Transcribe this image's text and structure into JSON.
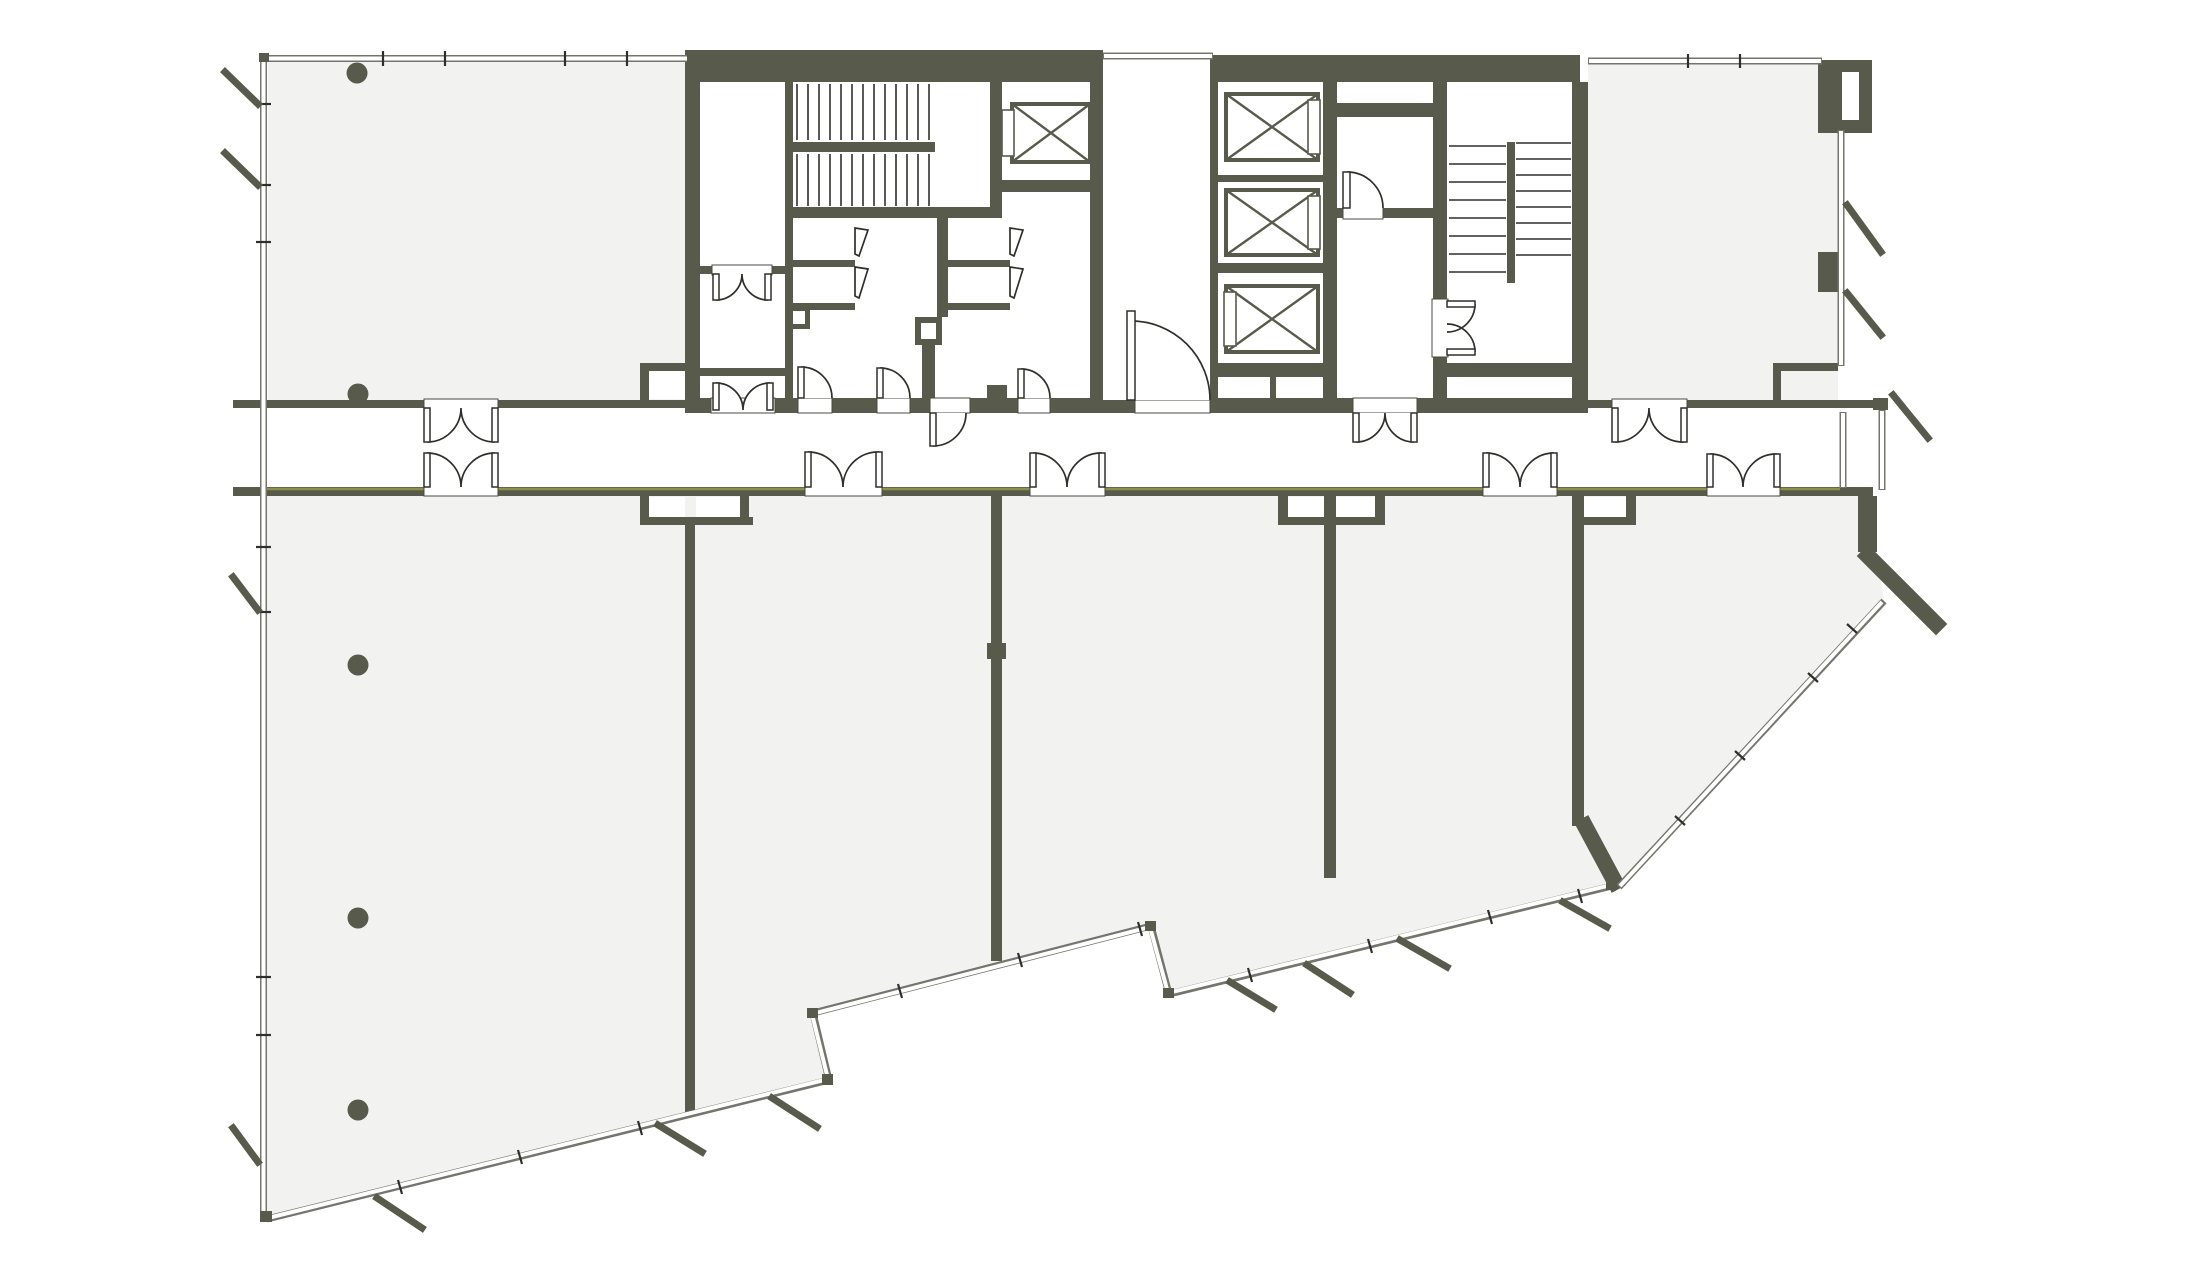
{
  "figure": {
    "kind": "architectural-floor-plan",
    "label": "office-tower-typical-floor-plan"
  },
  "colors": {
    "background": "#ffffff",
    "wall": "#585a4c",
    "tenant_floor": "#f2f2f0",
    "core_rooms": "#ffffff",
    "drawing_line": "#2f2f2a",
    "curtain_wall_line": "#75756c",
    "corridor_accent_line": "#8f8f4b"
  },
  "inventory": {
    "elevator_shafts": 4,
    "stairwells": 2,
    "structural_columns": 5,
    "double_swing_doors": 11,
    "single_swing_doors": 6,
    "wc_fixtures": 4,
    "facade_slash_marks": 14,
    "tenant_rooms": 7
  }
}
